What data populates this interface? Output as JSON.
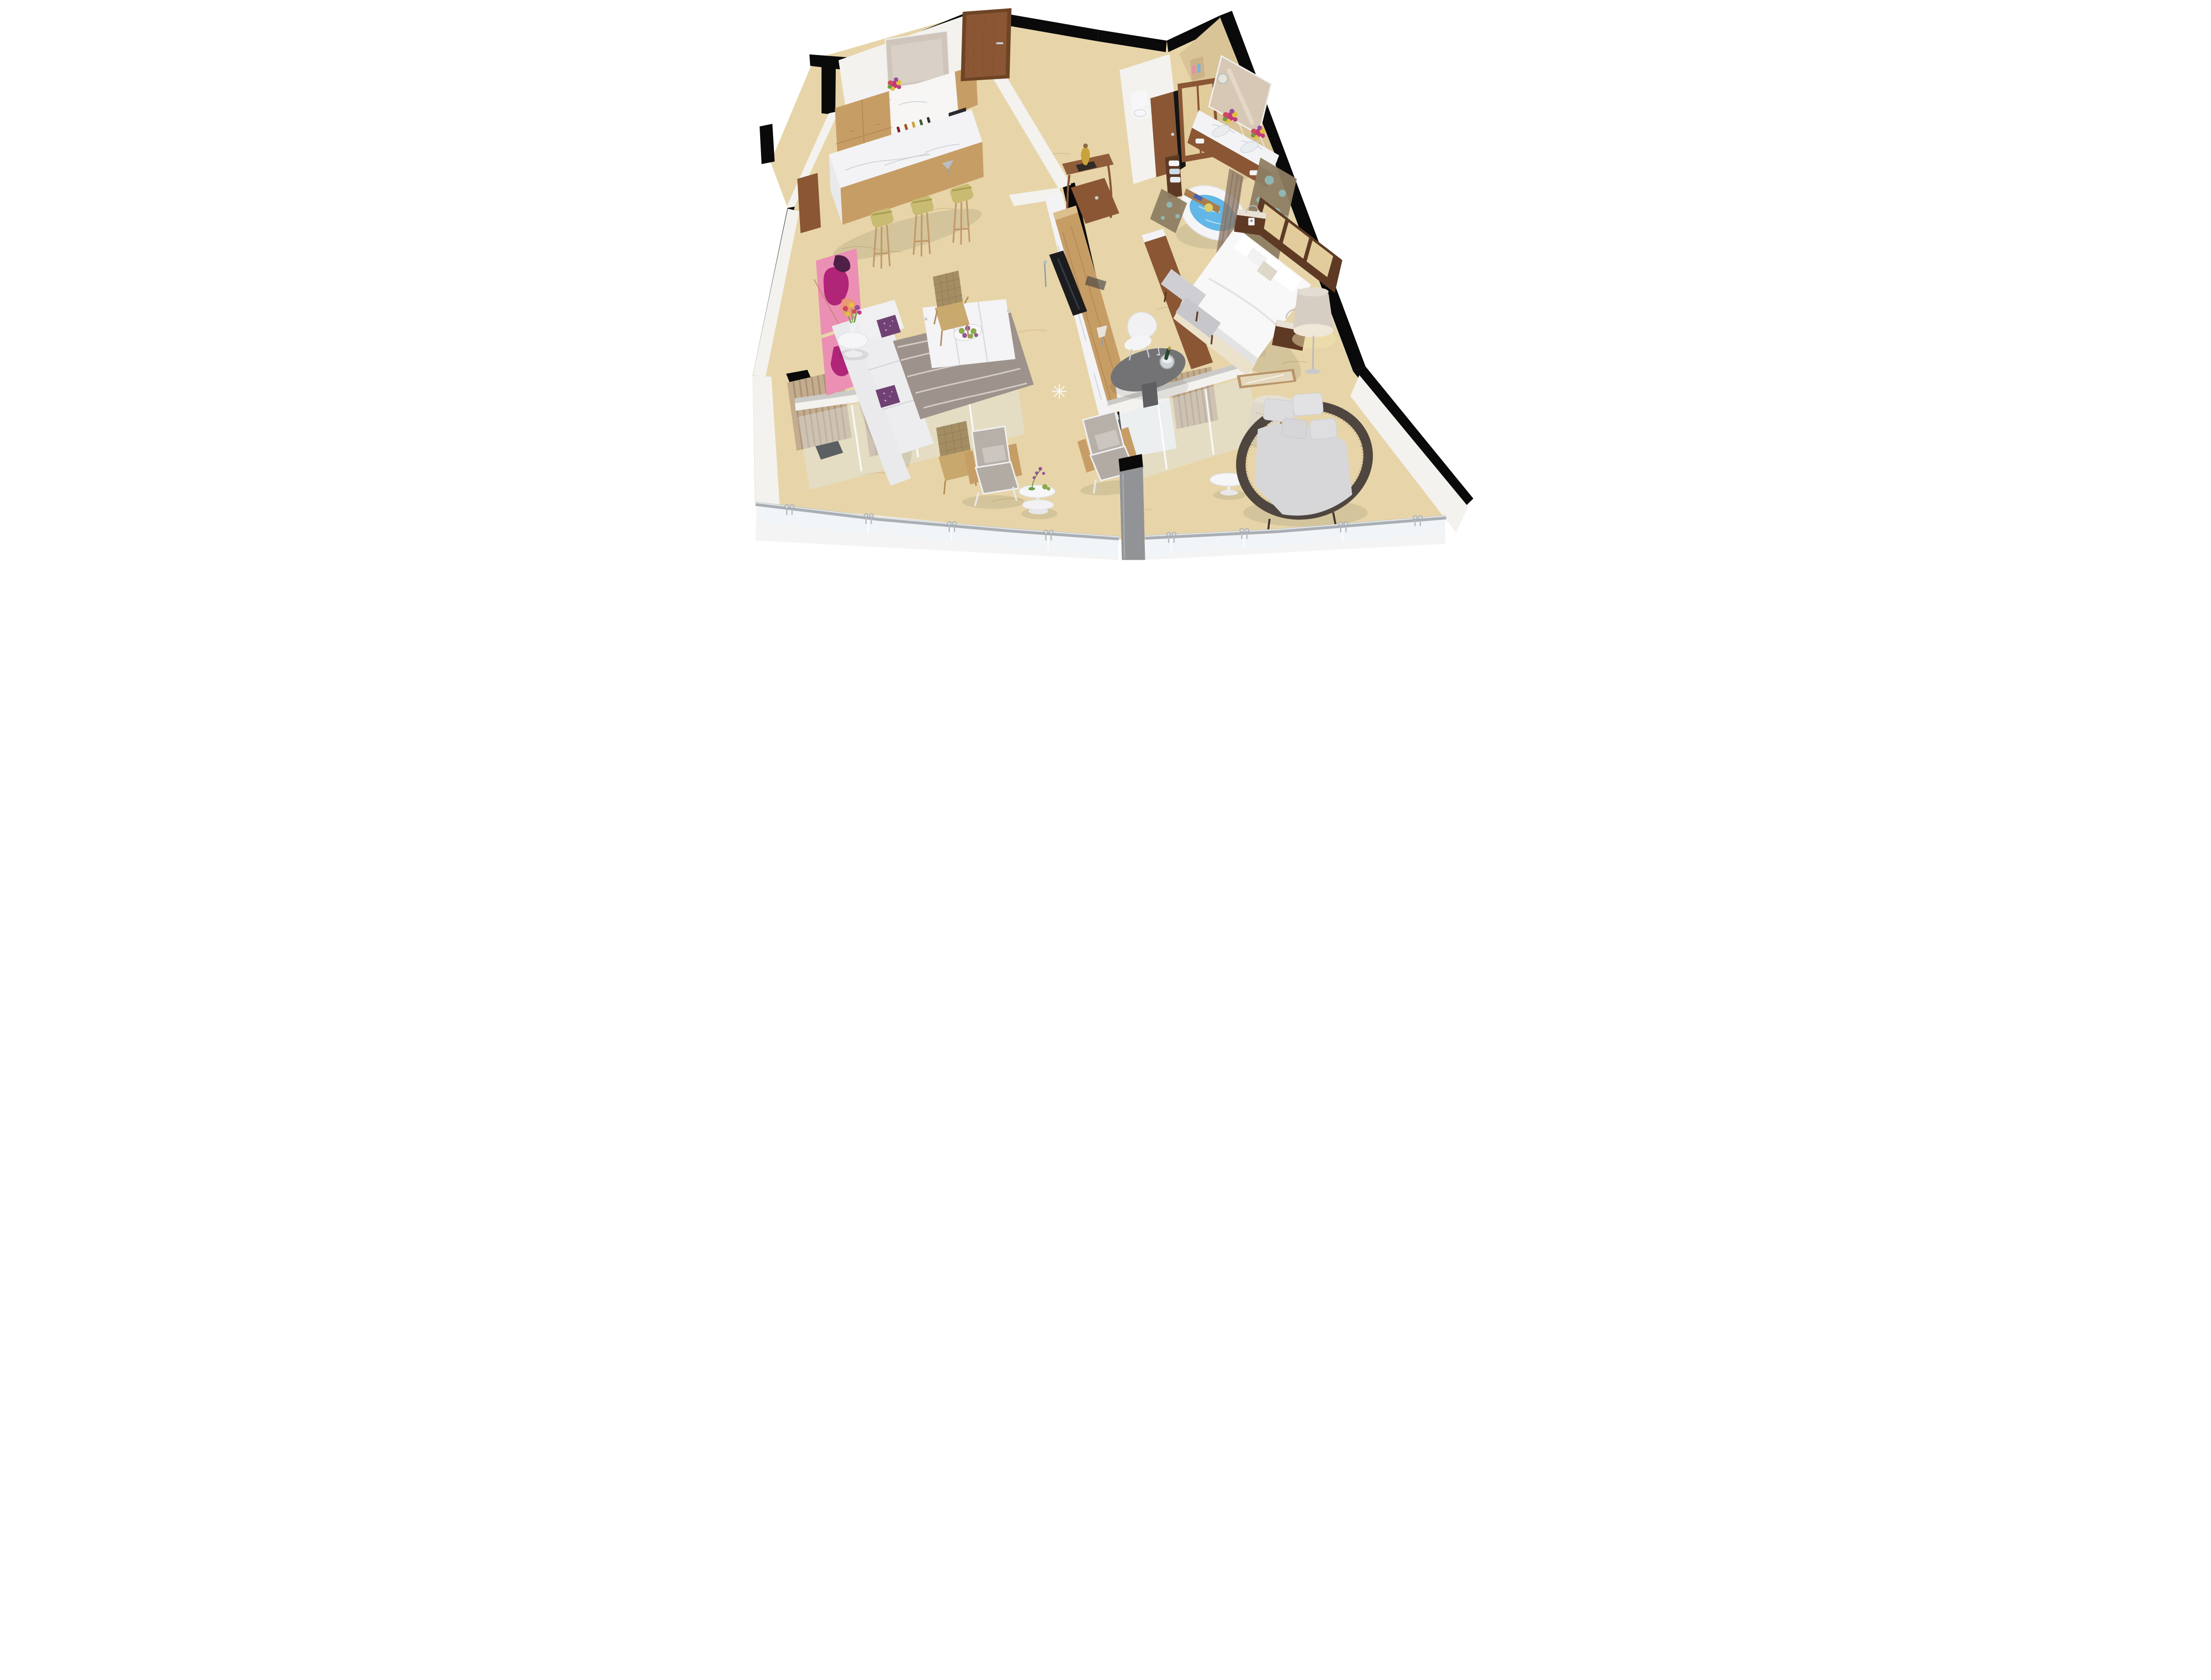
{
  "meta": {
    "type": "3d-floorplan-render",
    "description": "Photorealistic isometric cutaway 3D floor plan of a luxury hotel suite with kitchenette bar, entry foyer, wardrobe, water closet, master bathroom, media hallway, living room, master bedroom and a wrap-around glass-railed balcony terrace"
  },
  "colors": {
    "floor": "#e7d5a9",
    "floor-vein": "#bf9e68",
    "wall-black": "#0a0a0a",
    "wall-white": "#f3f2ef",
    "wall-cap": "#cbcac7",
    "wood-walnut": "#8a5634",
    "wood-walnut-dark": "#5e3a24",
    "wood-oak": "#c79d66",
    "wood-oak-light": "#dcbf8c",
    "marble-white": "#f3f3f5",
    "marble-vein": "#aab3c0",
    "stool-olive": "#c8bb72",
    "sofa-white": "#eaeaec",
    "sofa-shadow": "#d5d5d9",
    "pillow-purple": "#6f4273",
    "pillow-speck": "#cfa3d6",
    "art-pink": "#ec8fb4",
    "art-magenta": "#b02577",
    "art-orange": "#eb9a6e",
    "art-plum": "#4e1f47",
    "rug-gray": "#9e938c",
    "rug-line": "#d9d3cd",
    "bed-white": "#f8f8f8",
    "bed-shadow": "#e3e3e3",
    "bed-skirt": "#ece2cc",
    "headboard-tan": "#e2cc9b",
    "lamp-shade": "#d6cec3",
    "lamp-glow": "#f4e3ae",
    "chrome": "#b9bcc0",
    "steel": "#a9afb4",
    "desk-gray": "#737376",
    "chair-white": "#f1f1f3",
    "tub-white": "#f5f5f7",
    "water-blue": "#62b7e6",
    "water-light": "#aadaf2",
    "mosaic-bronze": "#8d7d62",
    "mosaic-teal": "#8fb6b2",
    "curtain-brown": "#8d7767",
    "curtain-beige": "#c4ac8e",
    "curtain-beige-dark": "#a78f72",
    "bath-marble": "#d9c498",
    "bath-marble-dark": "#cdb287",
    "toilet-white": "#f7f7f9",
    "glass-tint": "#dfe9ee",
    "rattan-dark": "#4e463f",
    "rattan-tan": "#a58d63",
    "daybed-cushion": "#d7d7d9",
    "flower-magenta": "#c13a7c",
    "flower-yellow": "#e4c03f",
    "flower-red": "#d14a5e",
    "flower-purple": "#9a4d9e",
    "leaf-green": "#6f9c45",
    "succulent-green": "#8aaa4c",
    "succulent-purple": "#96588f",
    "gold": "#c9a23a",
    "tv-black": "#1c1c1e",
    "pillar-gray": "#919396",
    "towel-blue": "#cfdde6"
  },
  "scene": {
    "rooms": [
      {
        "id": "powder-room",
        "label": "Powder room with vanity mirror, basin and flower bouquets"
      },
      {
        "id": "kitchenette-bar",
        "label": "Kitchenette bar with wine shelf, coffee machine, marble island and three bar stools"
      },
      {
        "id": "entry-foyer",
        "label": "Entry foyer with wooden door and console table with gold lamp"
      },
      {
        "id": "wardrobe-closet",
        "label": "Wardrobe closet with beige doors and towel shelf"
      },
      {
        "id": "water-closet",
        "label": "Water closet with toilet and wooden door"
      },
      {
        "id": "master-bathroom",
        "label": "Master bathroom with double vanity, mirror, freestanding bathtub, bath caddy and mosaic screens"
      },
      {
        "id": "media-wall",
        "label": "Media wall hallway with TV console on marble plinth"
      },
      {
        "id": "living-room",
        "label": "Living room with abstract art, white sectional sofa, purple pillows, tulip side table, coffee table with succulents, wavy rug and wicker chair"
      },
      {
        "id": "bedroom",
        "label": "Master bedroom with king bed, upholstered headboard, nightstands, floor lamp, foot bench, writing table with champagne bucket and armchair"
      },
      {
        "id": "balcony",
        "label": "Balcony terrace with lounge chairs, orchid side table, rattan daybed and glass railing"
      }
    ]
  }
}
